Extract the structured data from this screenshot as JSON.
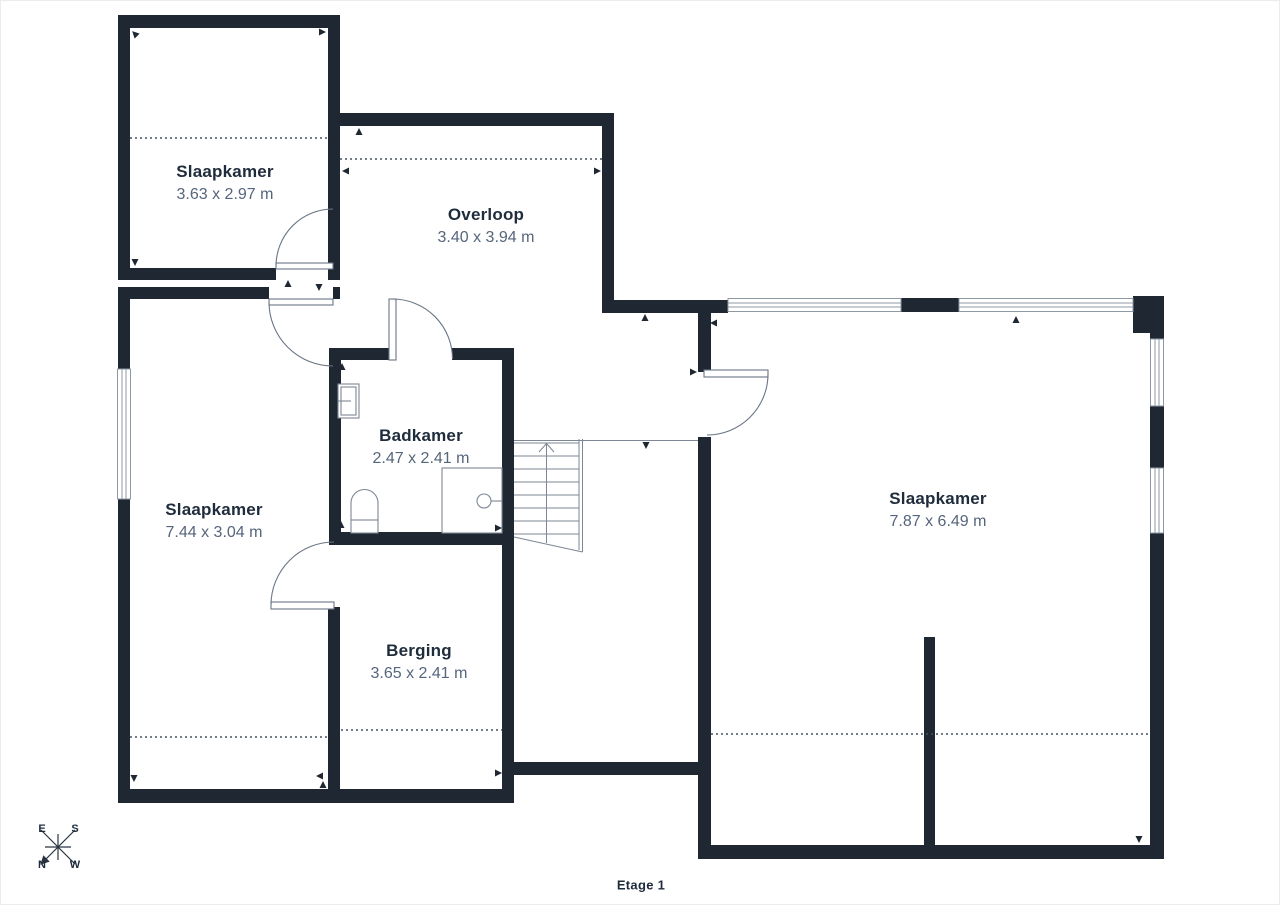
{
  "floorplan": {
    "floor_label": "Etage 1",
    "rooms": [
      {
        "name": "Slaapkamer",
        "dimensions": "3.63 x 2.97 m"
      },
      {
        "name": "Overloop",
        "dimensions": "3.40 x 3.94 m"
      },
      {
        "name": "Slaapkamer",
        "dimensions": "7.44 x 3.04 m"
      },
      {
        "name": "Badkamer",
        "dimensions": "2.47 x 2.41 m"
      },
      {
        "name": "Berging",
        "dimensions": "3.65 x 2.41 m"
      },
      {
        "name": "Slaapkamer",
        "dimensions": "7.87 x 6.49 m"
      }
    ],
    "compass": {
      "north": "N",
      "east": "E",
      "south": "S",
      "west": "W"
    },
    "colors": {
      "wall": "#1e2732",
      "room_name": "#1f2c3c",
      "room_dims": "#55657b",
      "thin_line": "#7d8795",
      "background": "#ffffff"
    },
    "fixtures": [
      "stairs-up",
      "toilet",
      "shower",
      "washbasin",
      "window",
      "door-swing"
    ]
  }
}
